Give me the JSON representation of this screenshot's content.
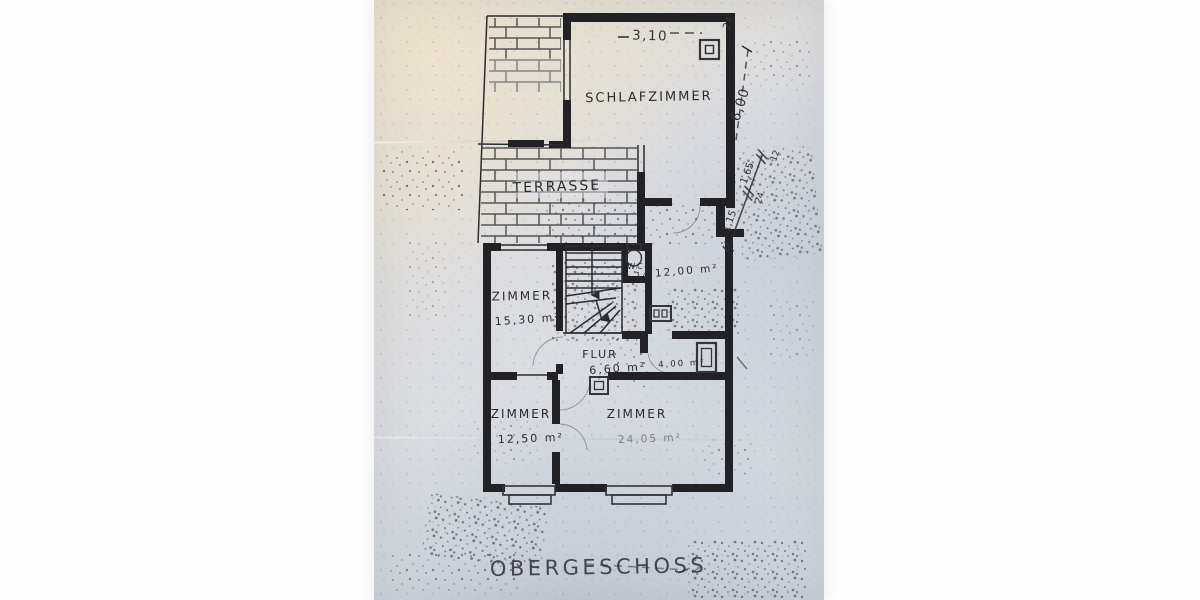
{
  "title": {
    "text": "OBERGESCHOSS"
  },
  "rooms": {
    "schlafzimmer": {
      "name": "SCHLAFZIMMER"
    },
    "terrasse": {
      "name": "TERRASSE"
    },
    "zimmer_nw": {
      "name": "ZIMMER",
      "area": "15,30 m²"
    },
    "wc": {
      "name": "WC",
      "area": "1,14"
    },
    "kammer_12": {
      "area": "12,00 m²"
    },
    "flur": {
      "name": "FLUR",
      "area": "6,60 m²"
    },
    "kammer_4": {
      "area": "4,00 m²"
    },
    "zimmer_sw": {
      "name": "ZIMMER",
      "area": "12,50 m²"
    },
    "zimmer_se": {
      "name": "ZIMMER",
      "area": "24,05 m²"
    }
  },
  "dimensions": {
    "top_width": "3,10",
    "top_wall_thickness": "24",
    "right_height": "6,00",
    "chain_seg_1": "1,15",
    "chain_seg_2": "1,65",
    "chain_wall": "24",
    "chain_end": "12"
  },
  "colors": {
    "ink": "#212126",
    "paper_warm": "#e8e1d2",
    "paper_cool": "#cfd5dd",
    "photo_background": "#fefefe"
  }
}
